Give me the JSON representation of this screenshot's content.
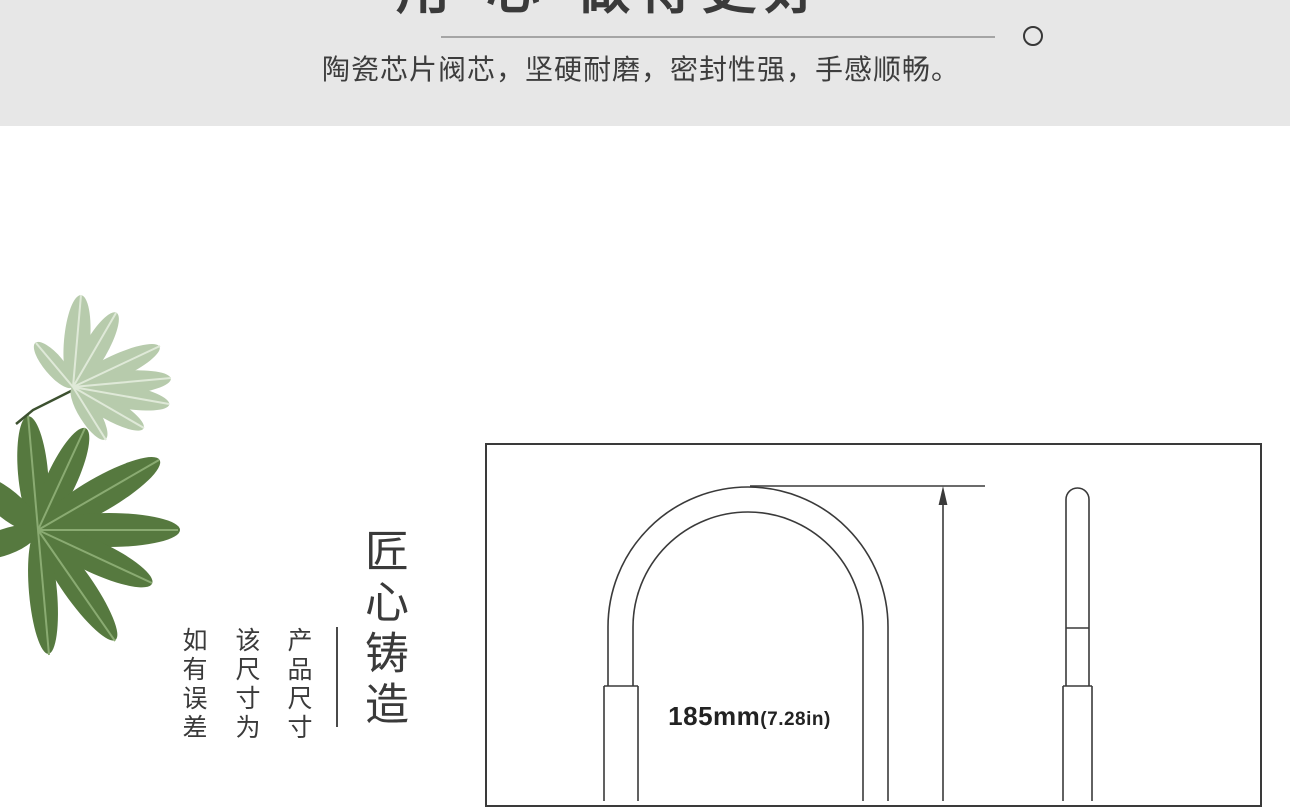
{
  "banner": {
    "title": "用·心·做得更好",
    "subtitle": "陶瓷芯片阀芯，坚硬耐磨，密封性强，手感顺畅。"
  },
  "craft": {
    "title": "匠心铸造",
    "notes": [
      "产品尺寸",
      "该尺寸为",
      "如有误差"
    ]
  },
  "drawing": {
    "dim_value": "185mm",
    "dim_inch": "(7.28in)"
  },
  "colors": {
    "banner_bg": "#e7e7e7",
    "text_dark": "#3a3a3a",
    "rule_gray": "#a5a5a5",
    "line_dark": "#3a3a3a",
    "leaf_light": "#b7cbac",
    "leaf_light_vein": "#dfe9d8",
    "leaf_dark": "#56793f",
    "leaf_dark_vein": "#8aab72"
  }
}
